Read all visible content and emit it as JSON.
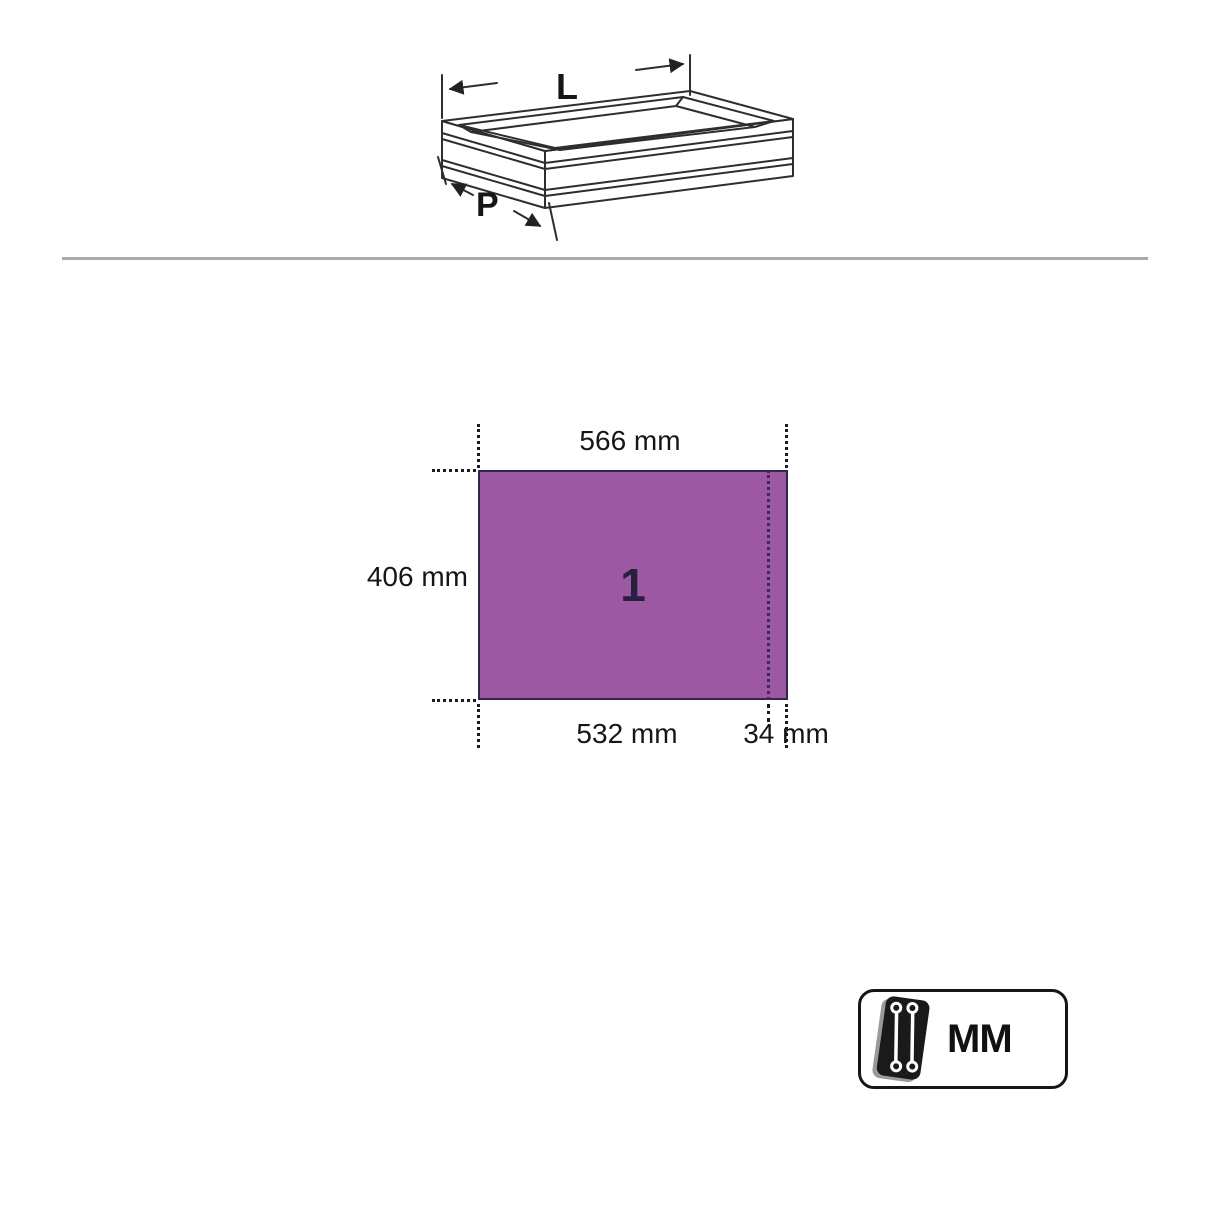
{
  "drawer_diagram": {
    "length_label": "L",
    "depth_label": "P"
  },
  "dimension_diagram": {
    "top_width": "566 mm",
    "left_height": "406 mm",
    "bottom_inner_width": "532 mm",
    "bottom_edge_width": "34 mm",
    "panel_number": "1",
    "panel_color": "#9c58a3",
    "panel_border_color": "#32264d"
  },
  "unit_badge": {
    "label": "MM"
  },
  "divider_color": "#a9a9a9"
}
